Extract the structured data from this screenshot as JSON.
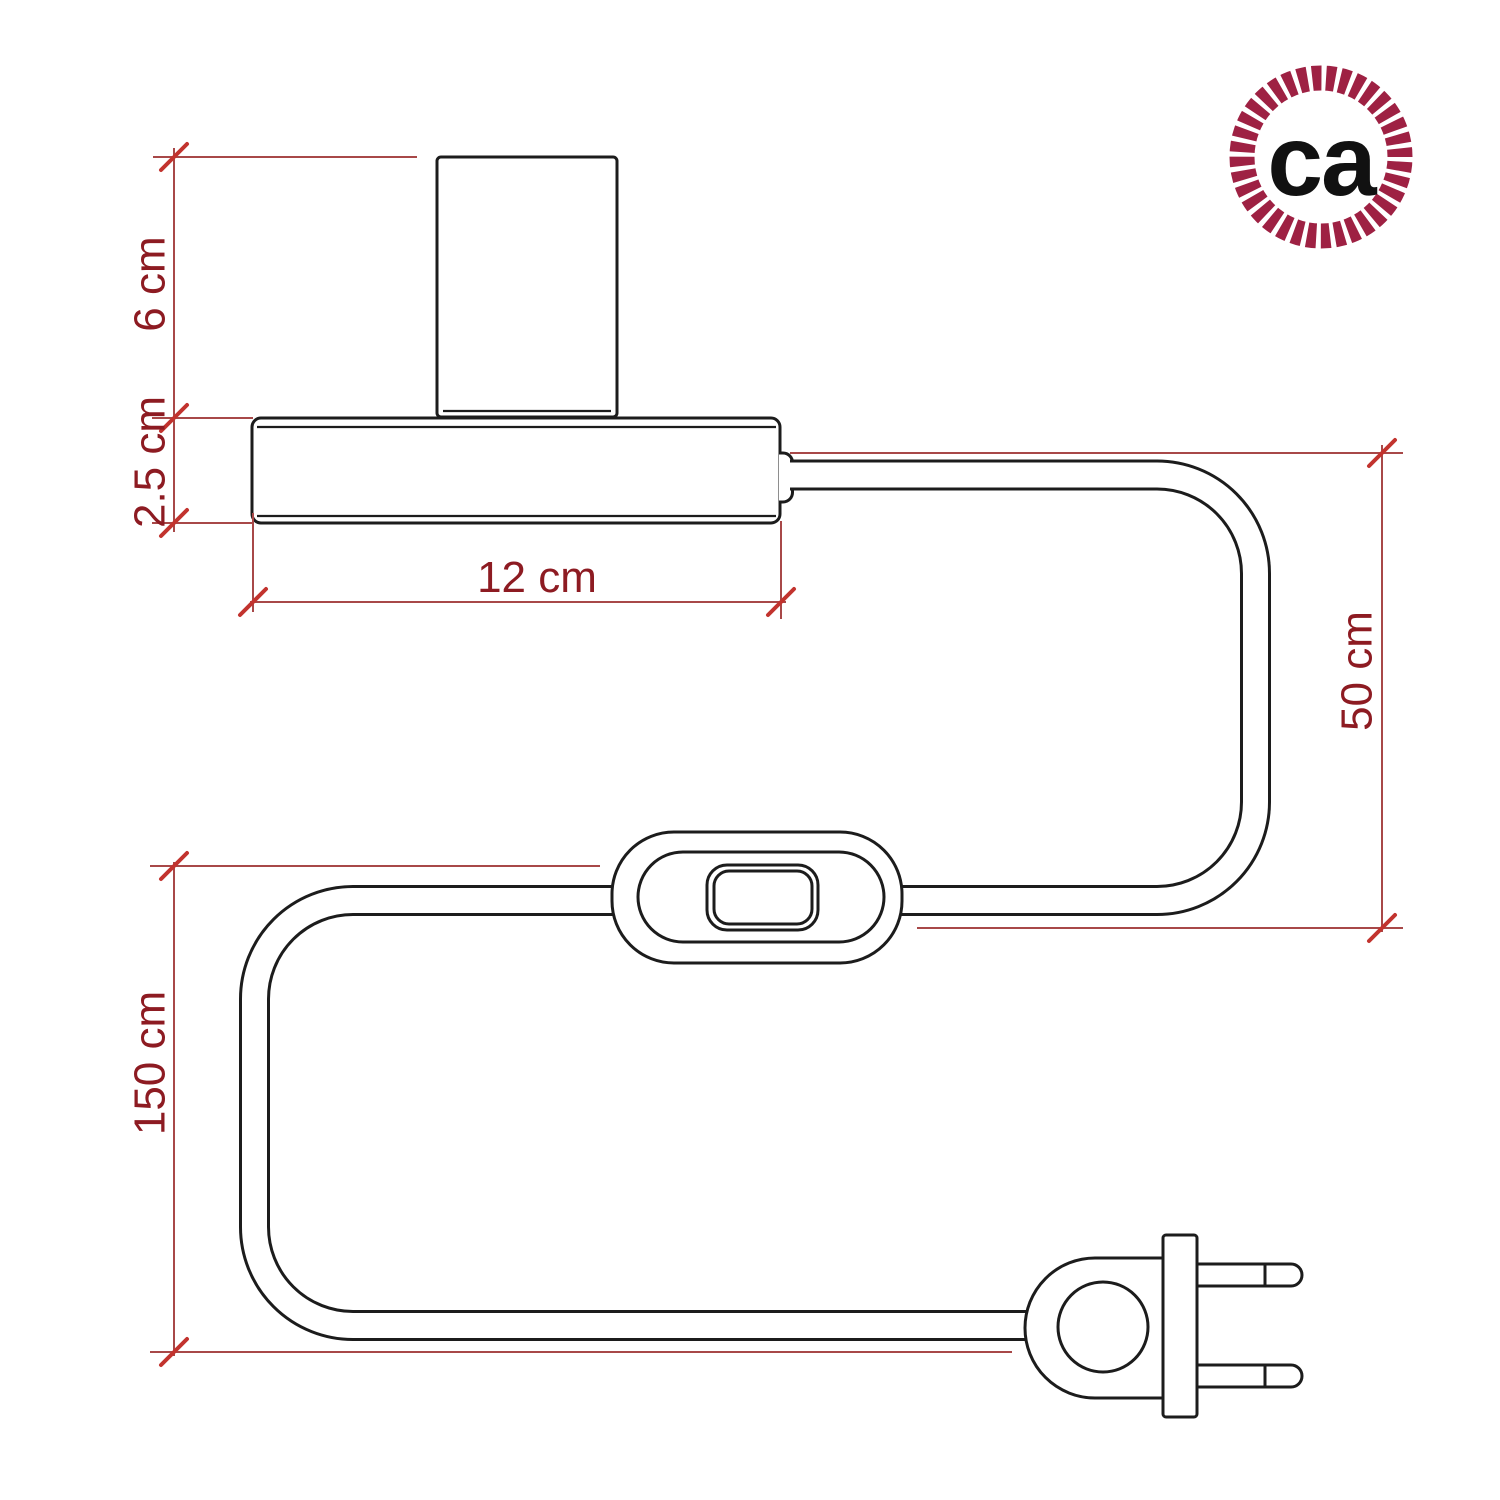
{
  "diagram": {
    "dimensions": {
      "socket_height": "6 cm",
      "base_height": "2.5 cm",
      "base_width": "12 cm",
      "cable_drop": "50 cm",
      "cable_length": "150 cm"
    },
    "colors": {
      "drawing_line": "#1c1c1c",
      "dimension_line": "#a84848",
      "dimension_tick": "#c2332e",
      "dimension_text": "#8d1b22",
      "logo_ring": "#9e2143",
      "logo_text": "#111111"
    }
  },
  "logo": {
    "text": "ca"
  }
}
